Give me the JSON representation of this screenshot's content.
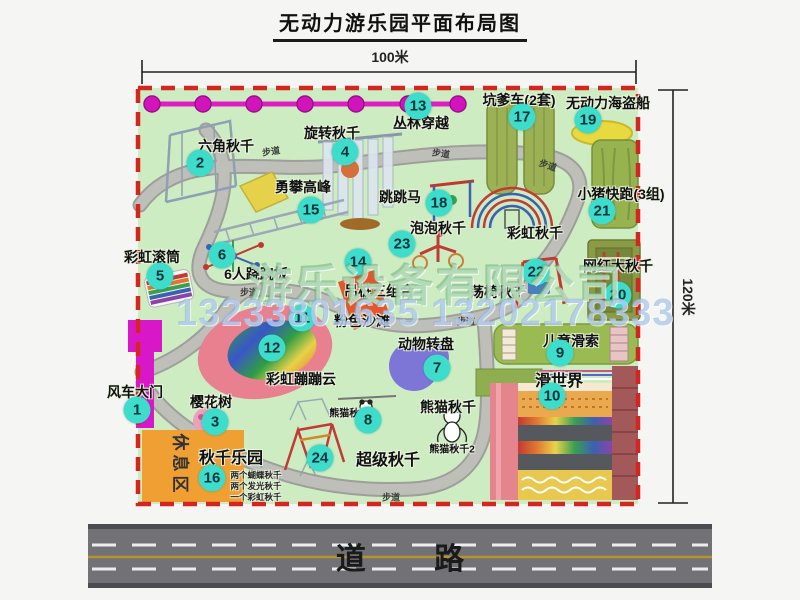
{
  "title": "无动力游乐园平面布局图",
  "dims": {
    "width": "100米",
    "height": "120米"
  },
  "road_label": "道 路",
  "watermark": {
    "company": "游乐设备有限公司",
    "phone": "13233801635 13202178333"
  },
  "attractions": {
    "a1": {
      "num": "1",
      "name": "风车大门"
    },
    "a2": {
      "num": "2",
      "name": "六角秋千"
    },
    "a3": {
      "num": "3",
      "name": "樱花树"
    },
    "a4": {
      "num": "4",
      "name": "旋转秋千"
    },
    "a5": {
      "num": "5",
      "name": "彩虹滚筒"
    },
    "a6": {
      "num": "6",
      "name": "6人跷跷板"
    },
    "a7": {
      "num": "7",
      "name": "动物转盘"
    },
    "a8": {
      "num": "8",
      "name": "熊猫秋千"
    },
    "a9": {
      "num": "9",
      "name": "儿童滑索"
    },
    "a10": {
      "num": "10",
      "name": "滑世界"
    },
    "a11": {
      "num": "11",
      "name": "粉色沙滩"
    },
    "a12": {
      "num": "12",
      "name": "彩虹蹦蹦云"
    },
    "a13": {
      "num": "13",
      "name": "丛林穿越"
    },
    "a14": {
      "num": "14",
      "name": "吊桩三组合"
    },
    "a15": {
      "num": "15",
      "name": "勇攀高峰"
    },
    "a16": {
      "num": "16",
      "name": "秋千乐园"
    },
    "a17": {
      "num": "17",
      "name": "坑爹车(2套)"
    },
    "a18": {
      "num": "18",
      "name": "跳跳马"
    },
    "a19": {
      "num": "19",
      "name": "无动力海盗船"
    },
    "a20": {
      "num": "20",
      "name": "网红大秋千"
    },
    "a21": {
      "num": "21",
      "name": "小猪快跑(3组)"
    },
    "a22": {
      "num": "22",
      "name": "荡椅秋千"
    },
    "a23": {
      "num": "23",
      "name": "泡泡秋千"
    },
    "a24": {
      "num": "24",
      "name": "超级秋千"
    }
  },
  "extra_labels": {
    "rainbow_swing": "彩虹秋千",
    "panda_swing_1": "熊猫秋千1",
    "panda_swing_2": "熊猫秋千2",
    "rest_area": "休息区",
    "footpath": "步道",
    "swing_note_1": "两个蝴蝶秋千",
    "swing_note_2": "两个发光秋千",
    "swing_note_3": "一个彩虹秋千"
  },
  "colors": {
    "park_green": "#cdecc1",
    "border_red": "#d4261f",
    "badge_cyan": "#3edcca",
    "gate_magenta": "#d818c8",
    "rest_orange": "#f0a032",
    "road_gray": "#717176"
  }
}
